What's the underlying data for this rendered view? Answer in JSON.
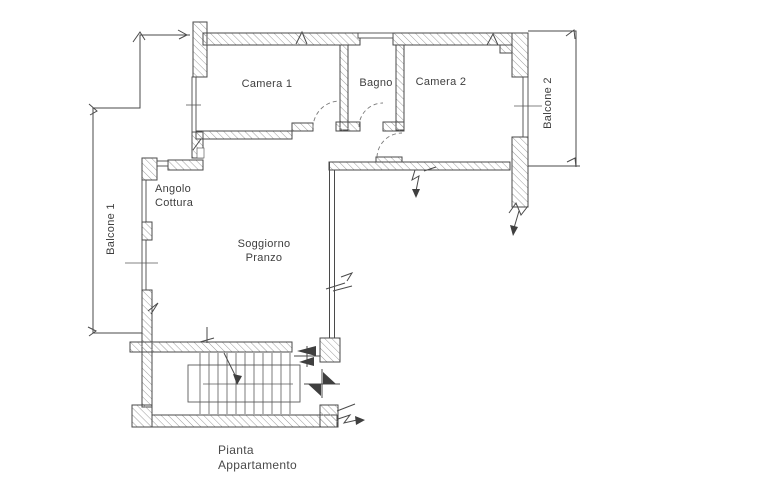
{
  "plan": {
    "title": {
      "line1": "Pianta",
      "line2": "Appartamento"
    },
    "rooms": {
      "camera1": {
        "label": "Camera 1"
      },
      "bagno": {
        "label": "Bagno"
      },
      "camera2": {
        "label": "Camera 2"
      },
      "balcone1": {
        "label": "Balcone 1"
      },
      "balcone2": {
        "label": "Balcone 2"
      },
      "angolo_cottura": {
        "line1": "Angolo",
        "line2": "Cottura"
      },
      "soggiorno": {
        "line1": "Soggiorno",
        "line2": "Pranzo"
      }
    },
    "colors": {
      "ink": "#4a4a4a",
      "hatch_line": "#9c9c9c",
      "label_text": "#3e3e3e",
      "paper": "#ffffff"
    }
  }
}
